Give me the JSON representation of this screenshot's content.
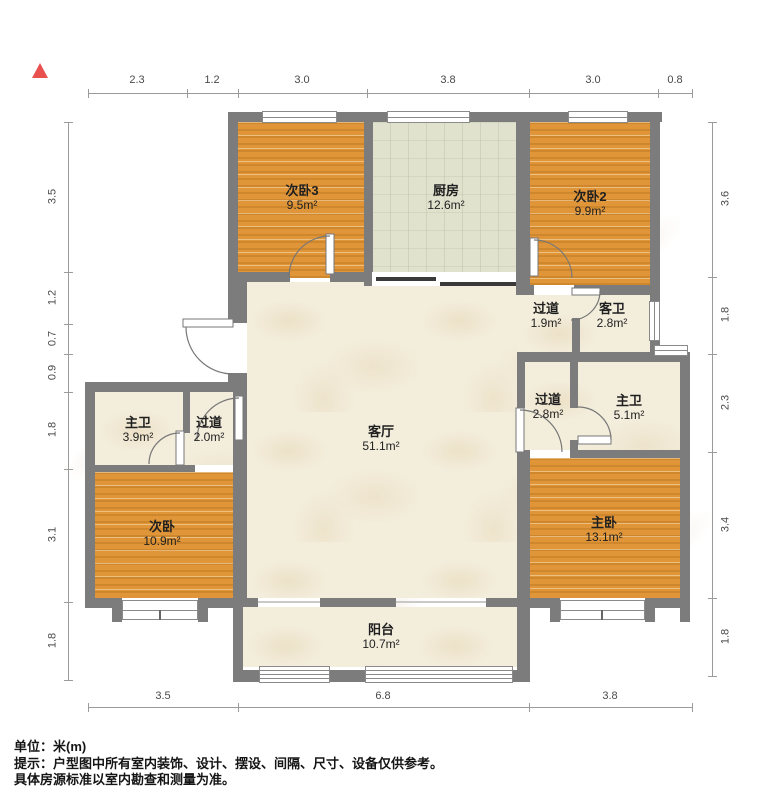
{
  "north_indicator": "▲",
  "dimensions": {
    "unit": "米(m)",
    "top": [
      "2.3",
      "1.2",
      "3.0",
      "3.8",
      "3.0",
      "0.8"
    ],
    "left": [
      "3.5",
      "1.2",
      "0.7",
      "0.9",
      "1.8",
      "3.1",
      "1.8"
    ],
    "right": [
      "3.6",
      "1.8",
      "2.3",
      "3.4",
      "1.8"
    ],
    "bottom": [
      "3.5",
      "6.8",
      "3.8"
    ]
  },
  "rooms": [
    {
      "name": "次卧3",
      "area": "9.5m²"
    },
    {
      "name": "厨房",
      "area": "12.6m²"
    },
    {
      "name": "次卧2",
      "area": "9.9m²"
    },
    {
      "name": "过道",
      "area": "1.9m²"
    },
    {
      "name": "客卫",
      "area": "2.8m²"
    },
    {
      "name": "主卫",
      "area": "3.9m²"
    },
    {
      "name": "过道",
      "area": "2.0m²"
    },
    {
      "name": "客厅",
      "area": "51.1m²"
    },
    {
      "name": "过道",
      "area": "2.8m²"
    },
    {
      "name": "主卫",
      "area": "5.1m²"
    },
    {
      "name": "次卧",
      "area": "10.9m²"
    },
    {
      "name": "主卧",
      "area": "13.1m²"
    },
    {
      "name": "阳台",
      "area": "10.7m²"
    }
  ],
  "footer": {
    "line1": "单位：米(m)",
    "line2": "提示：户型图中所有室内装饰、设计、摆设、间隔、尺寸、设备仅供参考。",
    "line3": "具体房源标准以室内勘查和测量为准。"
  },
  "colors": {
    "wall": "#7c7c7c",
    "wood_floor": "#e09638",
    "kitchen_tile": "#e0e2cd",
    "cream_floor": "#f3eddc",
    "north_arrow": "#e8514e"
  }
}
